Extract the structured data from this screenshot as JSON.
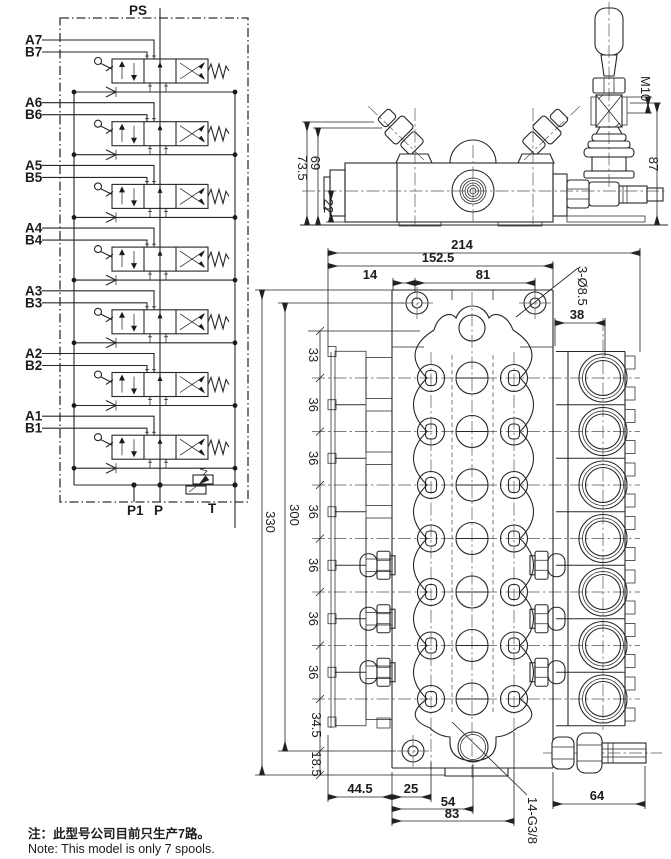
{
  "schematic": {
    "supply_label": "PS",
    "sections": [
      {
        "a": "A7",
        "b": "B7"
      },
      {
        "a": "A6",
        "b": "B6"
      },
      {
        "a": "A5",
        "b": "B5"
      },
      {
        "a": "A4",
        "b": "B4"
      },
      {
        "a": "A3",
        "b": "B3"
      },
      {
        "a": "A2",
        "b": "B2"
      },
      {
        "a": "A1",
        "b": "B1"
      }
    ],
    "ports": {
      "p1": "P1",
      "p": "P",
      "t": "T"
    }
  },
  "top_view": {
    "dim_height_left": "73.5",
    "dim_height_inner": "69",
    "dim_port_axis": "22",
    "dim_handle_height": "87",
    "thread_label": "M10"
  },
  "front_view": {
    "dim_width_total": "214",
    "dim_width_body": "152.5",
    "dim_hole_offset": "14",
    "dim_hole_spacing": "81",
    "hole_callout": "3-Ø8.5",
    "dim_port_offset": "38",
    "dim_top_section": "33",
    "dim_section_pitch": [
      "36",
      "36",
      "36",
      "36",
      "36",
      "36"
    ],
    "dim_bottom_section": "34.5",
    "dim_foot": "18.5",
    "dim_height_holes": "300",
    "dim_height_total": "330",
    "dim_bottom_left": "44.5",
    "dim_bottom_hole": "25",
    "dim_bottom_port": "54",
    "dim_bottom_col": "83",
    "dim_bottom_right": "64",
    "port_callout": "14-G3/8"
  },
  "note": {
    "zh": "注：此型号公司目前只生产7路。",
    "en": "Note: This model is only 7 spools."
  },
  "colors": {
    "line": "#262626",
    "background": "#ffffff"
  }
}
